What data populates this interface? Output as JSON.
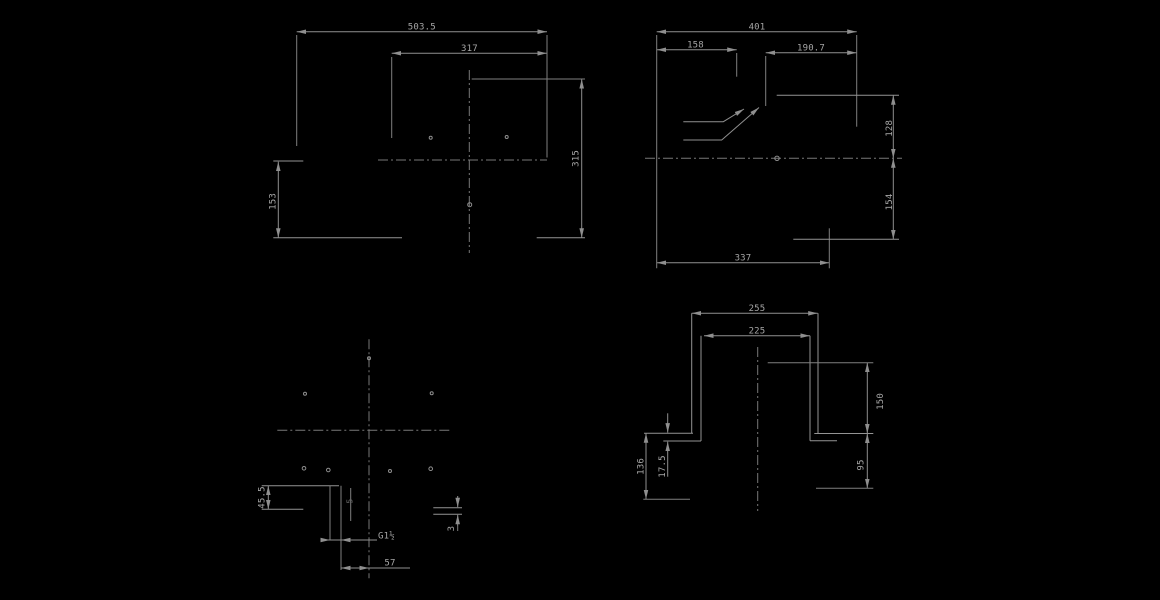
{
  "drawing": {
    "background_color": "#000000",
    "line_color": "#8f8f8f",
    "text_color": "#a6a6a6",
    "views": {
      "front": {
        "title": "front-view",
        "labels": {
          "overall_width": "503.5",
          "inner_width": "317",
          "height_total": "315",
          "height_lower": "153"
        }
      },
      "side": {
        "title": "side-view",
        "labels": {
          "overall_depth": "401",
          "front_depth": "158",
          "rear_depth": "190.7",
          "height_upper": "128",
          "height_lower": "154",
          "base_depth": "337"
        }
      },
      "plan": {
        "title": "plan-view",
        "labels": {
          "corner_offset": "45.5",
          "drain_thread": "G1½",
          "drain_offset": "57",
          "edge_gap": "3",
          "detail_mark": "5"
        }
      },
      "section": {
        "title": "section-view",
        "labels": {
          "outer_width": "255",
          "inner_width": "225",
          "height_right_upper": "150",
          "height_right_lower": "95",
          "height_left": "136",
          "flange_gap": "17.5"
        }
      }
    }
  }
}
